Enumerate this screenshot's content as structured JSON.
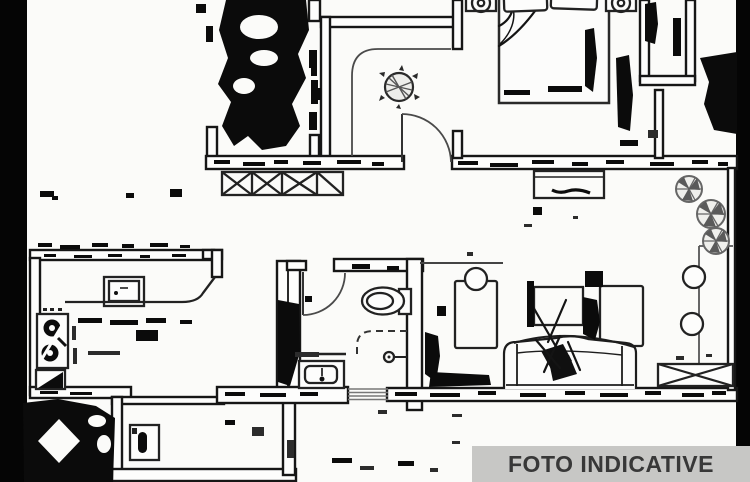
{
  "banner": {
    "label": "FOTO INDICATIVE"
  },
  "colors": {
    "bg": "#fbfbf9",
    "ink": "#161616",
    "noise": "#0b0b0b",
    "light": "#555555",
    "banner_bg": "#c7c7c5",
    "banner_text": "#383838"
  },
  "floor_plan": {
    "style": "black-and-white scanned apartment floor plan with heavy scan noise",
    "fixtures": [
      "double-bed-icon",
      "pillow-icon",
      "nightstand-lamp-icon",
      "door-swing-arc",
      "wardrobe-x-icon",
      "entry-plant-icon",
      "radiator-icon",
      "toilet-icon",
      "shower-icon",
      "washbasin-icon",
      "kitchen-hob-icon",
      "kitchen-counter",
      "kitchen-wall-cabinet-icon",
      "corner-cabinet-icon",
      "washing-machine-icon",
      "sofa-icon",
      "throw-pillow-icon",
      "coffee-table-icon",
      "desk-icon",
      "chair-icon",
      "tv-cabinet-icon",
      "balcony-plant-icon",
      "balcony-stool-icon",
      "balcony-table-x-icon"
    ]
  }
}
